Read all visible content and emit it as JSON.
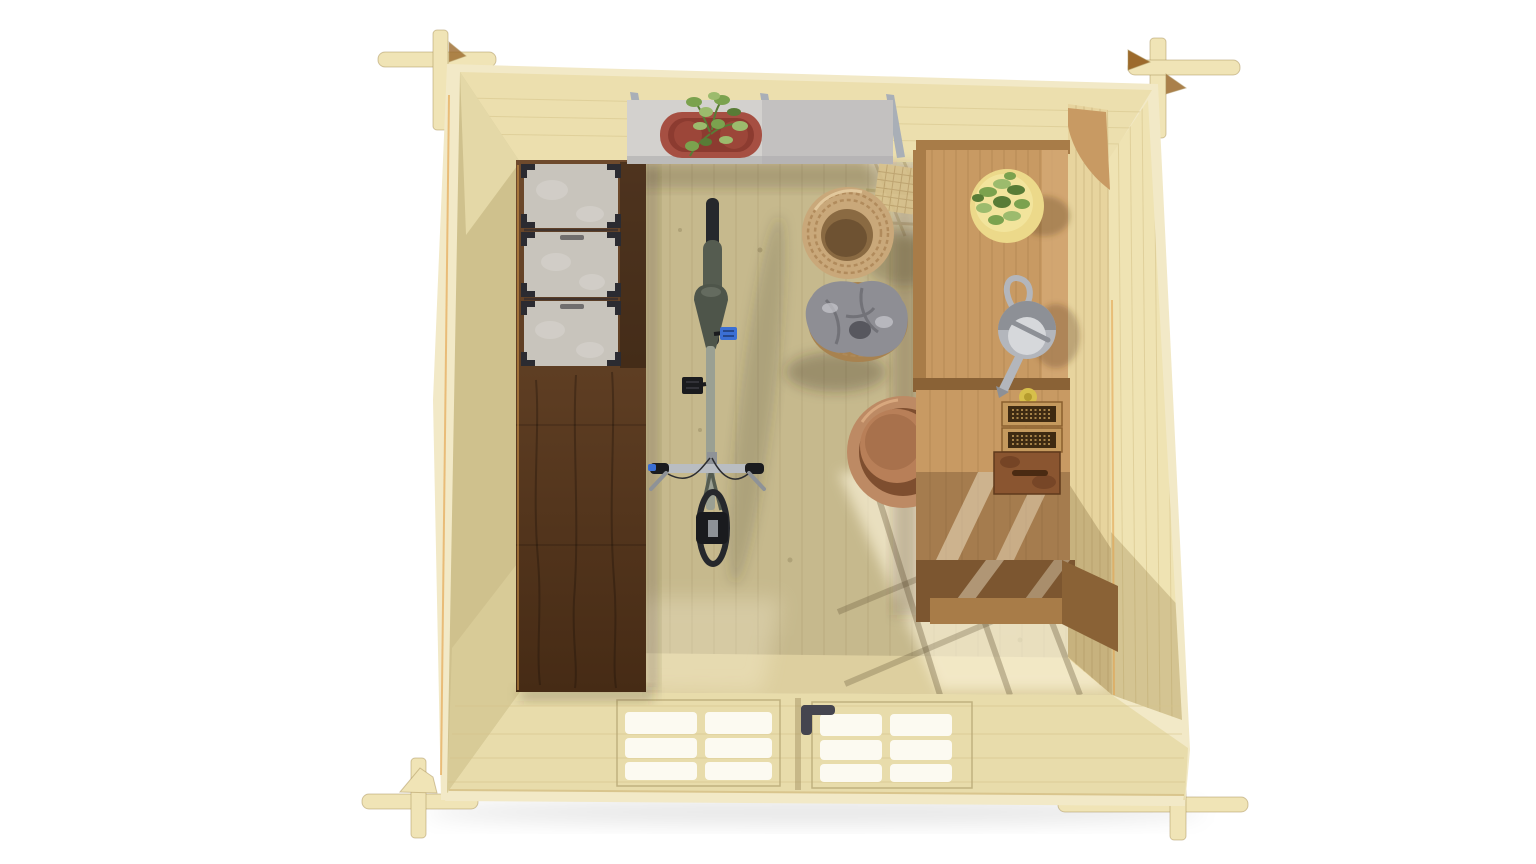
{
  "scene": {
    "title": "Top-down 3D render of a log-cabin garden shed interior",
    "view": "overhead architectural render, roof removed",
    "background": "#ffffff"
  },
  "objects": {
    "structure": [
      "corner-log-joints",
      "back-wall",
      "left-wall",
      "right-wall",
      "front-wall-with-glazed-double-doors",
      "plank-floor"
    ],
    "furniture": [
      "dark-walnut-storage-cabinet",
      "wall-mounted-shelf",
      "potting-bench-upper",
      "potting-bench-lower"
    ],
    "storage": [
      "gray-storage-box",
      "gray-storage-box",
      "gray-storage-box",
      "seed-tray",
      "seed-tray",
      "rusty-metal-box"
    ],
    "plants": [
      "red-planter-with-plant",
      "yellow-dish-with-plant",
      "terracotta-pot"
    ],
    "items": [
      "bicycle",
      "wicker-basket",
      "basket-with-gray-blanket",
      "watering-can",
      "twine-ball",
      "door-handle"
    ],
    "lighting": [
      "sun-patches-through-windows",
      "soft-interior-shadows"
    ]
  },
  "colors": {
    "bg": "#ffffff",
    "pine_outer": "#f2e9c7",
    "pine_wall_back": "#ecdfae",
    "pine_wall_left": "#cfc18d",
    "pine_wall_left_light": "#e8dcab",
    "pine_wall_right": "#efe3b3",
    "pine_floor_green": "#c6b98d",
    "pine_floor_tan": "#ded0a0",
    "pine_floor_line": "#a89b71",
    "pine_band_line": "#d6c38b",
    "sun_patch": "#fff7de",
    "log_beam": "#f0e4b6",
    "log_edge": "#d9c58d",
    "log_accent_brown": "#9c6a2c",
    "cabinet_grain": "#6e4a2c",
    "cabinet_darker": "#462b15",
    "box_gray": "#c8c4bc",
    "box_gray_light": "#d9d6d0",
    "box_clip": "#2b2b31",
    "shelf_gray": "#d3d1ce",
    "shelf_edge": "#bcbbba",
    "bracket_gray": "#a9afb7",
    "planter_red": "#a64f42",
    "planter_red_dark": "#8c3b30",
    "plant_green": "#7ba24e",
    "plant_green_light": "#9cbb6d",
    "plant_green_dark": "#587c36",
    "bench_wood": "#c89a63",
    "bench_wood_light": "#d4a974",
    "bench_wood_dark": "#a87c48",
    "bench_frame_dark": "#8a6236",
    "bench_under": "#7c5630",
    "side_panel": "#e7d49e",
    "side_panel_line": "#c9b47e",
    "pot_terracotta": "#bd8a64",
    "pot_terracotta_dark": "#a8714c",
    "pot_mid": "#b87f58",
    "dish_yellow": "#ecd98a",
    "dish_yellow_light": "#f2e49c",
    "can_gray": "#b3b6bc",
    "can_gray_dark": "#8d9096",
    "can_lid": "#d6d8db",
    "twine_yellow": "#d7bf4a",
    "tray_frame": "#c59a5e",
    "tray_dark": "#3e2a12",
    "tray_dot": "#c9a05a",
    "rust_box": "#8a5530",
    "rust_box_dark": "#6f4023",
    "wicker": "#c9a87a",
    "wicker_dark": "#b18b5c",
    "wicker_inner": "#8a6a42",
    "wicker_deep": "#6e5232",
    "blanket_gray": "#8e8e94",
    "blanket_dark": "#5f5f66",
    "blanket_light": "#c9c9ce",
    "blanket_deep": "#4a4a50",
    "basket_warm": "#a8824f",
    "bike_tire": "#26282c",
    "bike_fender": "#555c50",
    "bike_saddle": "#4e554a",
    "bike_frame": "#9aa093",
    "bike_silver": "#b9bdc2",
    "bike_silver_dark": "#8e9297",
    "bike_black": "#1a1b1e",
    "bike_blue": "#3b6fd4",
    "pane_white": "#fcfaf1",
    "door_frame": "#b7a674",
    "handle_dark": "#45454f",
    "rim_light": "#e3a44e",
    "trellis": "#d9c28b",
    "trellis_line": "#b79a63"
  }
}
